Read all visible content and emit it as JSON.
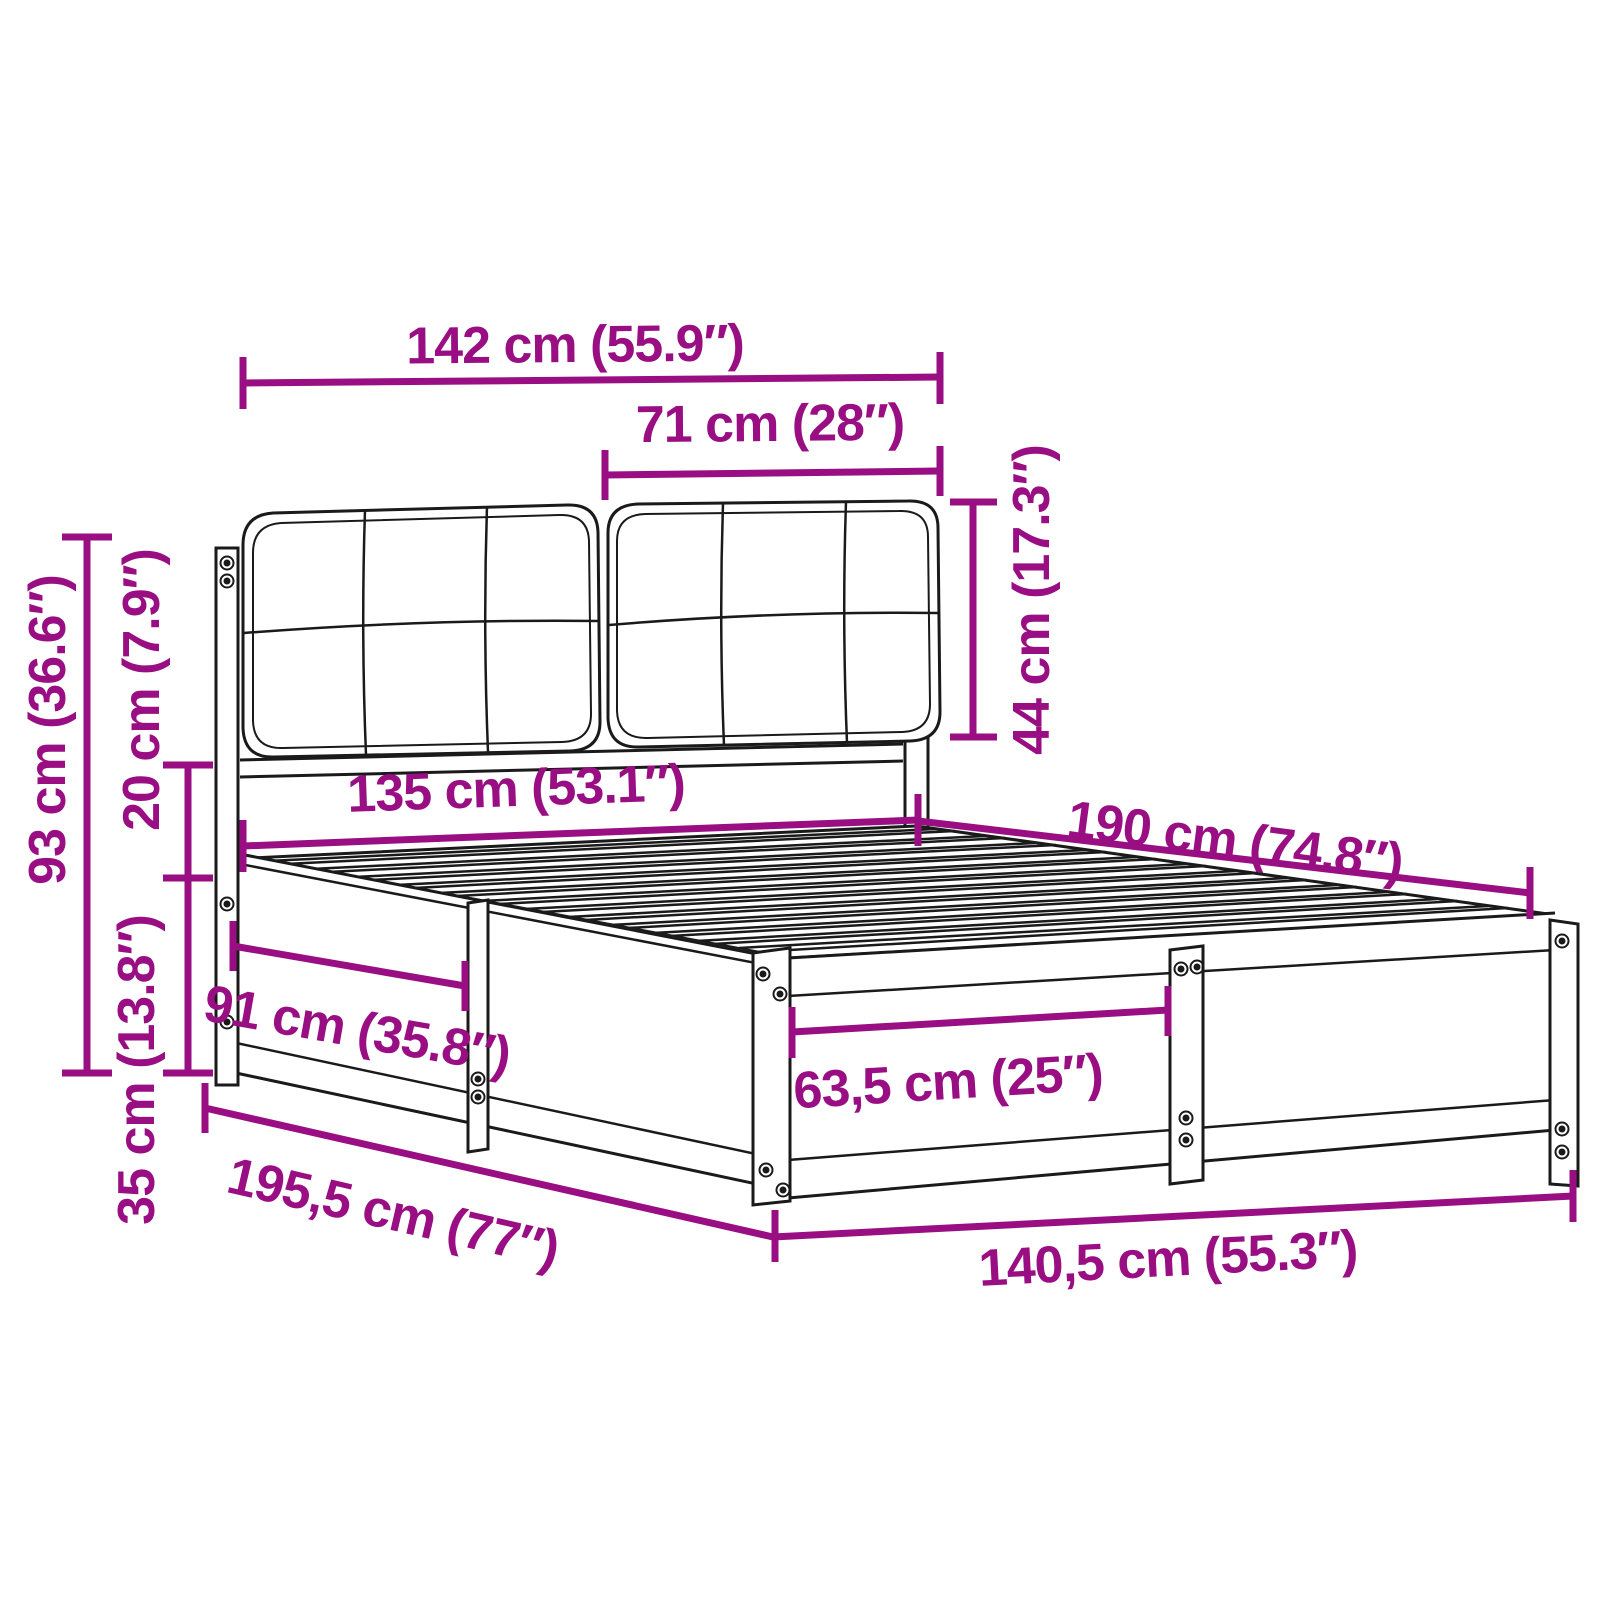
{
  "meta": {
    "diagram_type": "product-dimension-diagram",
    "subject": "bed-frame-with-upholstered-headboard-cushions",
    "units": [
      "cm",
      "inches"
    ]
  },
  "colors": {
    "accent_magenta": "#990e82",
    "line_art_black": "#1a1a1a",
    "background": "#ffffff"
  },
  "labels": {
    "headboard_width": "142 cm (55.9″)",
    "cushion_width": "71 cm (28″)",
    "cushion_height": "44 cm (17.3″)",
    "mattress_width": "135 cm (53.1″)",
    "inner_length": "190 cm (74.8″)",
    "headboard_height": "93 cm (36.6″)",
    "rail_gap_height": "20 cm (7.9″)",
    "base_height": "35 cm (13.8″)",
    "side_panel_length": "91 cm (35.8″)",
    "foot_panel_width": "63,5 cm (25″)",
    "outer_length": "195,5 cm (77″)",
    "outer_width": "140,5 cm (55.3″)"
  }
}
